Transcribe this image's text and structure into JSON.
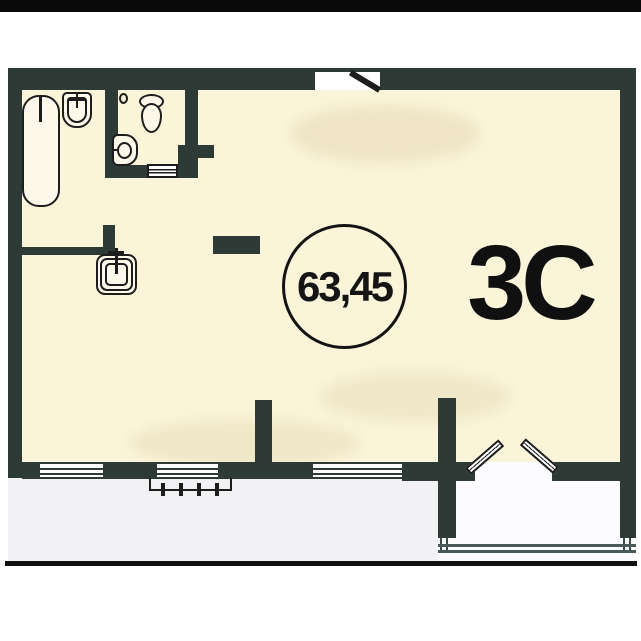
{
  "plan": {
    "unit_label": "3C",
    "area_label": "63,45",
    "colors": {
      "wall": "#2d3a36",
      "interior_fill": "#faf4d9",
      "exterior_fill": "#f2f2f4",
      "balcony_fill": "#fcfcfe",
      "outline": "#1d1d1d",
      "top_bar": "#0a0a0a",
      "text": "#141414"
    },
    "fixtures": [
      "bathtub-icon",
      "bath-sink-icon",
      "toilet-icon",
      "bidet-icon",
      "sliding-door-icon",
      "kitchen-sink-icon"
    ],
    "symbols": [
      "window-symbol",
      "entrance-door-leaf",
      "french-door-leaf",
      "balcony-railing-symbol",
      "balcony-glazing-lines"
    ]
  }
}
